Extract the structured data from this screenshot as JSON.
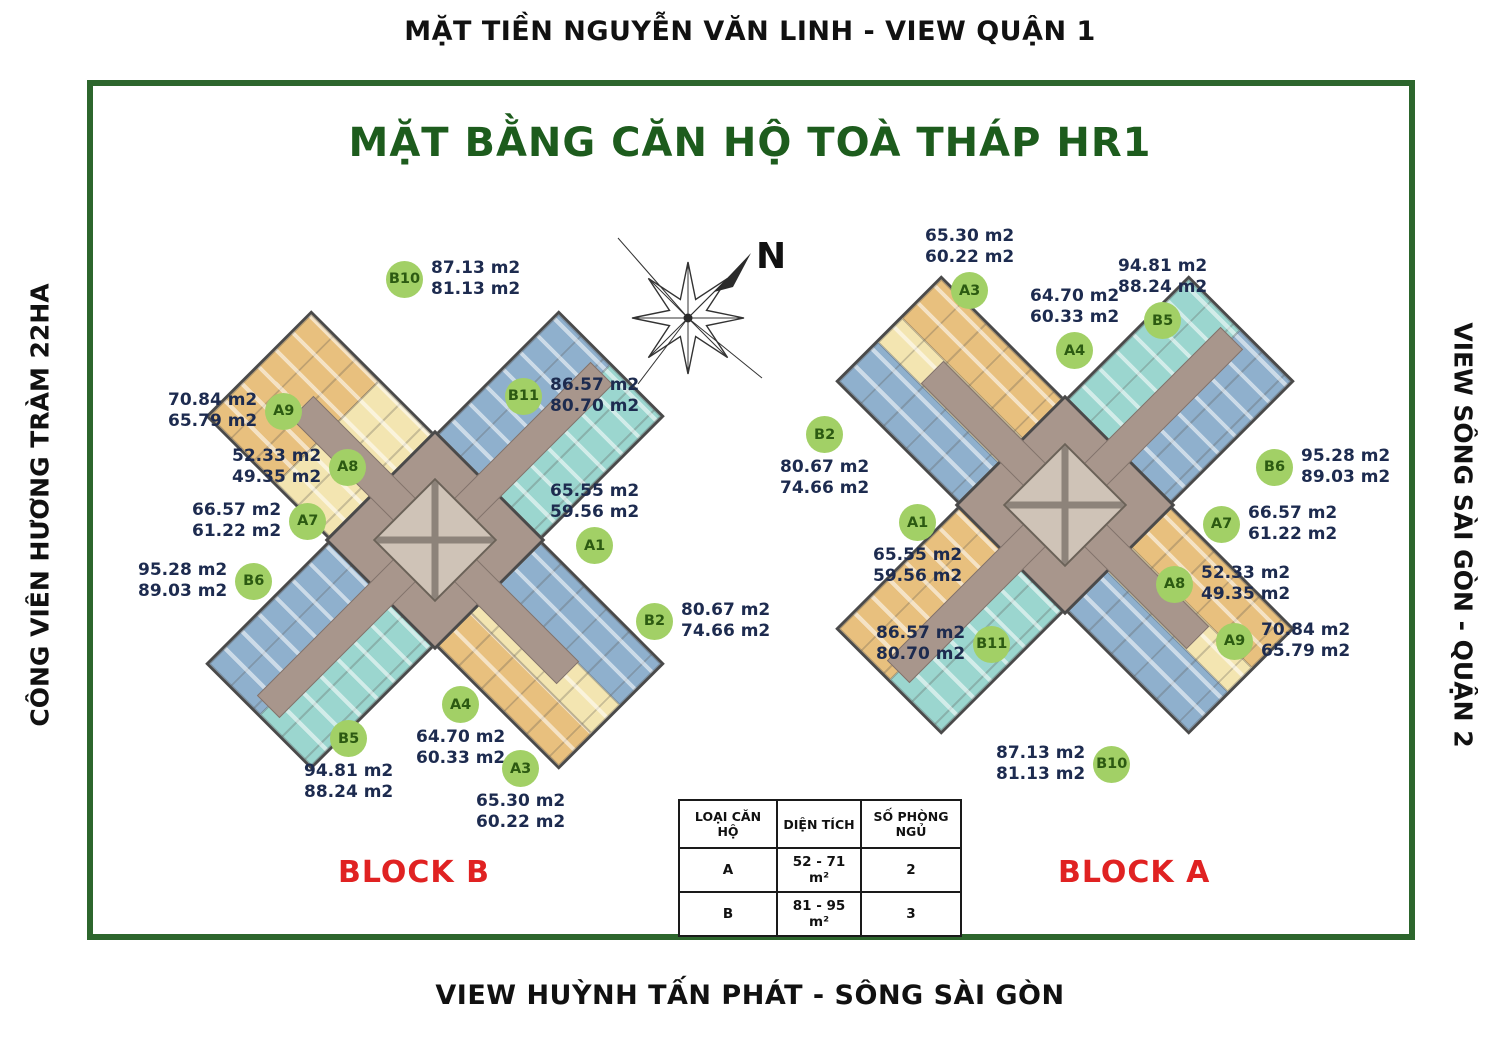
{
  "labels": {
    "top": "MẶT TIỀN NGUYỄN VĂN LINH - VIEW QUẬN 1",
    "title": "MẶT BẰNG CĂN HỘ TOÀ THÁP HR1",
    "left": "CÔNG VIÊN HƯƠNG TRÀM 22HA",
    "right": "VIEW SÔNG SÀI GÒN - QUẬN 2",
    "bottom": "VIEW HUỲNH TẤN PHÁT - SÔNG SÀI GÒN",
    "compass": "N"
  },
  "blocks": [
    {
      "name": "BLOCK B",
      "units": [
        {
          "id": "B10",
          "area1": "87.13 m2",
          "area2": "81.13 m2"
        },
        {
          "id": "B11",
          "area1": "86.57 m2",
          "area2": "80.70 m2"
        },
        {
          "id": "A9",
          "area1": "70.84 m2",
          "area2": "65.79 m2"
        },
        {
          "id": "A8",
          "area1": "52.33 m2",
          "area2": "49.35 m2"
        },
        {
          "id": "A7",
          "area1": "66.57 m2",
          "area2": "61.22 m2"
        },
        {
          "id": "B6",
          "area1": "95.28 m2",
          "area2": "89.03 m2"
        },
        {
          "id": "A1",
          "area1": "65.55 m2",
          "area2": "59.56 m2"
        },
        {
          "id": "B2",
          "area1": "80.67 m2",
          "area2": "74.66 m2"
        },
        {
          "id": "A4",
          "area1": "64.70 m2",
          "area2": "60.33 m2"
        },
        {
          "id": "B5",
          "area1": "94.81 m2",
          "area2": "88.24 m2"
        },
        {
          "id": "A3",
          "area1": "65.30 m2",
          "area2": "60.22 m2"
        }
      ]
    },
    {
      "name": "BLOCK A",
      "units": [
        {
          "id": "A3",
          "area1": "65.30 m2",
          "area2": "60.22 m2"
        },
        {
          "id": "A4",
          "area1": "64.70 m2",
          "area2": "60.33 m2"
        },
        {
          "id": "B5",
          "area1": "94.81 m2",
          "area2": "88.24 m2"
        },
        {
          "id": "B2",
          "area1": "80.67 m2",
          "area2": "74.66 m2"
        },
        {
          "id": "B6",
          "area1": "95.28 m2",
          "area2": "89.03 m2"
        },
        {
          "id": "A1",
          "area1": "65.55 m2",
          "area2": "59.56 m2"
        },
        {
          "id": "A7",
          "area1": "66.57 m2",
          "area2": "61.22 m2"
        },
        {
          "id": "A8",
          "area1": "52.33 m2",
          "area2": "49.35 m2"
        },
        {
          "id": "A9",
          "area1": "70.84 m2",
          "area2": "65.79 m2"
        },
        {
          "id": "B11",
          "area1": "86.57 m2",
          "area2": "80.70 m2"
        },
        {
          "id": "B10",
          "area1": "87.13 m2",
          "area2": "81.13 m2"
        }
      ]
    }
  ],
  "legend_table": {
    "headers": [
      "LOẠI CĂN HỘ",
      "DIỆN TÍCH",
      "SỐ PHÒNG NGỦ"
    ],
    "rows": [
      {
        "type": "A",
        "area": "52 - 71 m²",
        "bedrooms": "2"
      },
      {
        "type": "B",
        "area": "81 - 95 m²",
        "bedrooms": "3"
      }
    ]
  },
  "colors": {
    "frame": "#2d662d",
    "title": "#1d5c1d",
    "text": "#111111",
    "area": "#1d2b4f",
    "red": "#e02222",
    "badge": "#a2d066",
    "badge_text": "#2c5a12",
    "orange": "#e8c07e",
    "yellow": "#f3e5b1",
    "blue": "#8fb0cd",
    "teal": "#9bd6cf",
    "corridor": "#a8968c",
    "core": "#cfc3b7",
    "wall": "#4a4a4a"
  }
}
